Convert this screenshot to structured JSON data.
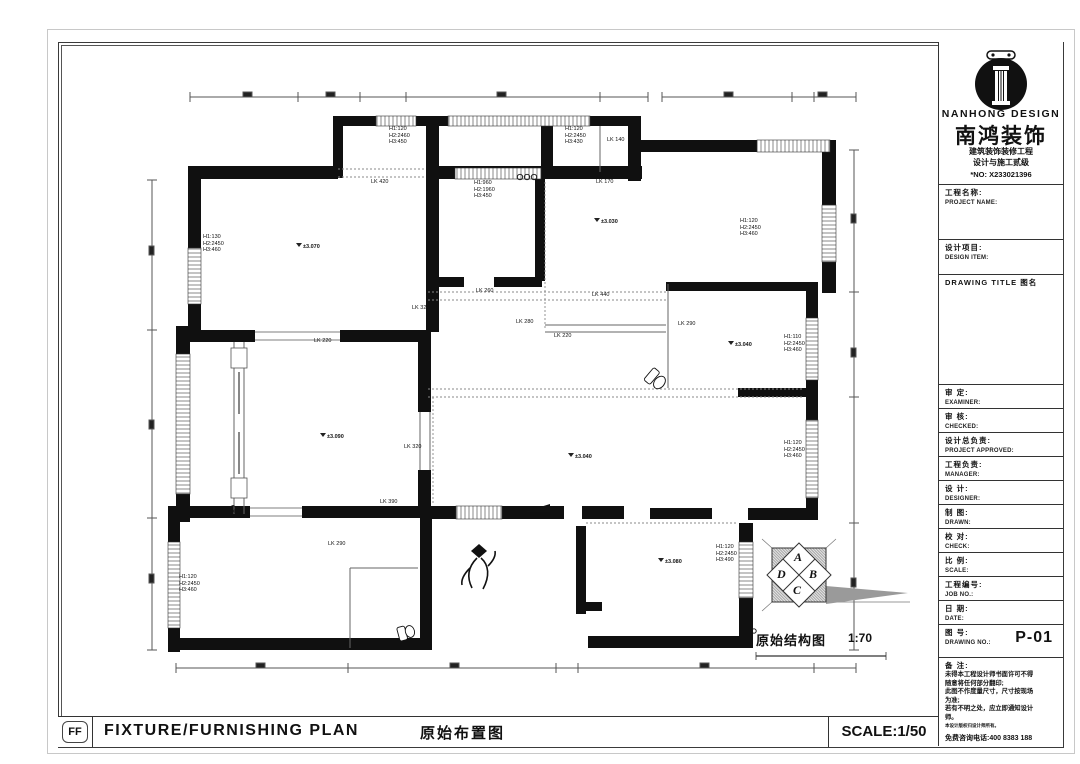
{
  "logo_block": {
    "brand_en": "NANHONG DESIGN",
    "brand_cn": "南鸿装饰",
    "sub1": "建筑装饰装修工程",
    "sub2": "设计与施工贰级",
    "no_line": "*NO: X233021396"
  },
  "title_block": {
    "fields": [
      {
        "cn": "工程名称:",
        "en": "PROJECT NAME:"
      },
      {
        "cn": "设计项目:",
        "en": "DESIGN ITEM:"
      },
      {
        "cn": "DRAWING TITLE 图名",
        "en": ""
      },
      {
        "cn": "审  定:",
        "en": "EXAMINER:"
      },
      {
        "cn": "审  核:",
        "en": "CHECKED:"
      },
      {
        "cn": "设计总负责:",
        "en": "PROJECT APPROVED:"
      },
      {
        "cn": "工程负责:",
        "en": "MANAGER:"
      },
      {
        "cn": "设  计:",
        "en": "DESIGNER:"
      },
      {
        "cn": "制  图:",
        "en": "DRAWN:"
      },
      {
        "cn": "校  对:",
        "en": "CHECK:"
      },
      {
        "cn": "比  例:",
        "en": "SCALE:"
      },
      {
        "cn": "工程编号:",
        "en": "JOB NO.:"
      },
      {
        "cn": "日  期:",
        "en": "DATE:"
      }
    ],
    "drawing_no": {
      "cn": "图  号:",
      "en": "DRAWING NO.:",
      "value": "P-01"
    },
    "notes": {
      "cn": "备  注:",
      "lines": [
        "未得本工程设计师书面许可不得",
        "随意将任何部分翻印;",
        "此图不作度量尺寸，尺寸按现场",
        "为准;",
        "若有不明之处，应立即通知设计",
        "师。"
      ],
      "fine": "本设计版权归设计师所有。",
      "phone": "免费咨询电话:400 8383 188"
    }
  },
  "bottom_bar": {
    "badge": "FF",
    "title_en": "FIXTURE/FURNISHING PLAN",
    "title_cn": "原始布置图",
    "scale": "SCALE:1/50"
  },
  "plan": {
    "caption": "原始结构图",
    "caption_scale": "1:70",
    "compass_letters": [
      "A",
      "B",
      "C",
      "D"
    ],
    "h_labels": [
      {
        "x": 203,
        "y": 234,
        "lines": [
          "H1:130",
          "H2:2450",
          "H3:460"
        ]
      },
      {
        "x": 389,
        "y": 126,
        "lines": [
          "H1:120",
          "H2:2460",
          "H3:450"
        ]
      },
      {
        "x": 565,
        "y": 126,
        "lines": [
          "H1:120",
          "H2:2450",
          "H3:430"
        ]
      },
      {
        "x": 474,
        "y": 180,
        "lines": [
          "H1:960",
          "H2:1960",
          "H3:450"
        ]
      },
      {
        "x": 740,
        "y": 218,
        "lines": [
          "H1:120",
          "H2:2450",
          "H3:460"
        ]
      },
      {
        "x": 784,
        "y": 334,
        "lines": [
          "H1:110",
          "H2:2450",
          "H3:460"
        ]
      },
      {
        "x": 784,
        "y": 440,
        "lines": [
          "H1:120",
          "H2:2450",
          "H3:460"
        ]
      },
      {
        "x": 716,
        "y": 544,
        "lines": [
          "H1:120",
          "H2:2450",
          "H3:490"
        ]
      },
      {
        "x": 179,
        "y": 574,
        "lines": [
          "H1:120",
          "H2:2450",
          "H3:460"
        ]
      }
    ],
    "lk_labels": [
      {
        "x": 371,
        "y": 179,
        "text": "LK 420"
      },
      {
        "x": 596,
        "y": 179,
        "text": "LK 170"
      },
      {
        "x": 607,
        "y": 137,
        "text": "LK 140"
      },
      {
        "x": 412,
        "y": 305,
        "text": "LK 320"
      },
      {
        "x": 516,
        "y": 319,
        "text": "LK 280"
      },
      {
        "x": 554,
        "y": 333,
        "text": "LK 220"
      },
      {
        "x": 592,
        "y": 292,
        "text": "LK 440"
      },
      {
        "x": 678,
        "y": 321,
        "text": "LK 290"
      },
      {
        "x": 314,
        "y": 338,
        "text": "LK 220"
      },
      {
        "x": 404,
        "y": 444,
        "text": "LK 320"
      },
      {
        "x": 380,
        "y": 499,
        "text": "LK 390"
      },
      {
        "x": 328,
        "y": 541,
        "text": "LK 290"
      },
      {
        "x": 476,
        "y": 288,
        "text": "LK 260"
      }
    ],
    "elevations": [
      {
        "x": 296,
        "y": 243,
        "text": "±3.070"
      },
      {
        "x": 594,
        "y": 218,
        "text": "±3.030"
      },
      {
        "x": 320,
        "y": 433,
        "text": "±3.090"
      },
      {
        "x": 568,
        "y": 453,
        "text": "±3.040"
      },
      {
        "x": 728,
        "y": 341,
        "text": "±3.040"
      },
      {
        "x": 658,
        "y": 558,
        "text": "±3.080"
      }
    ]
  }
}
